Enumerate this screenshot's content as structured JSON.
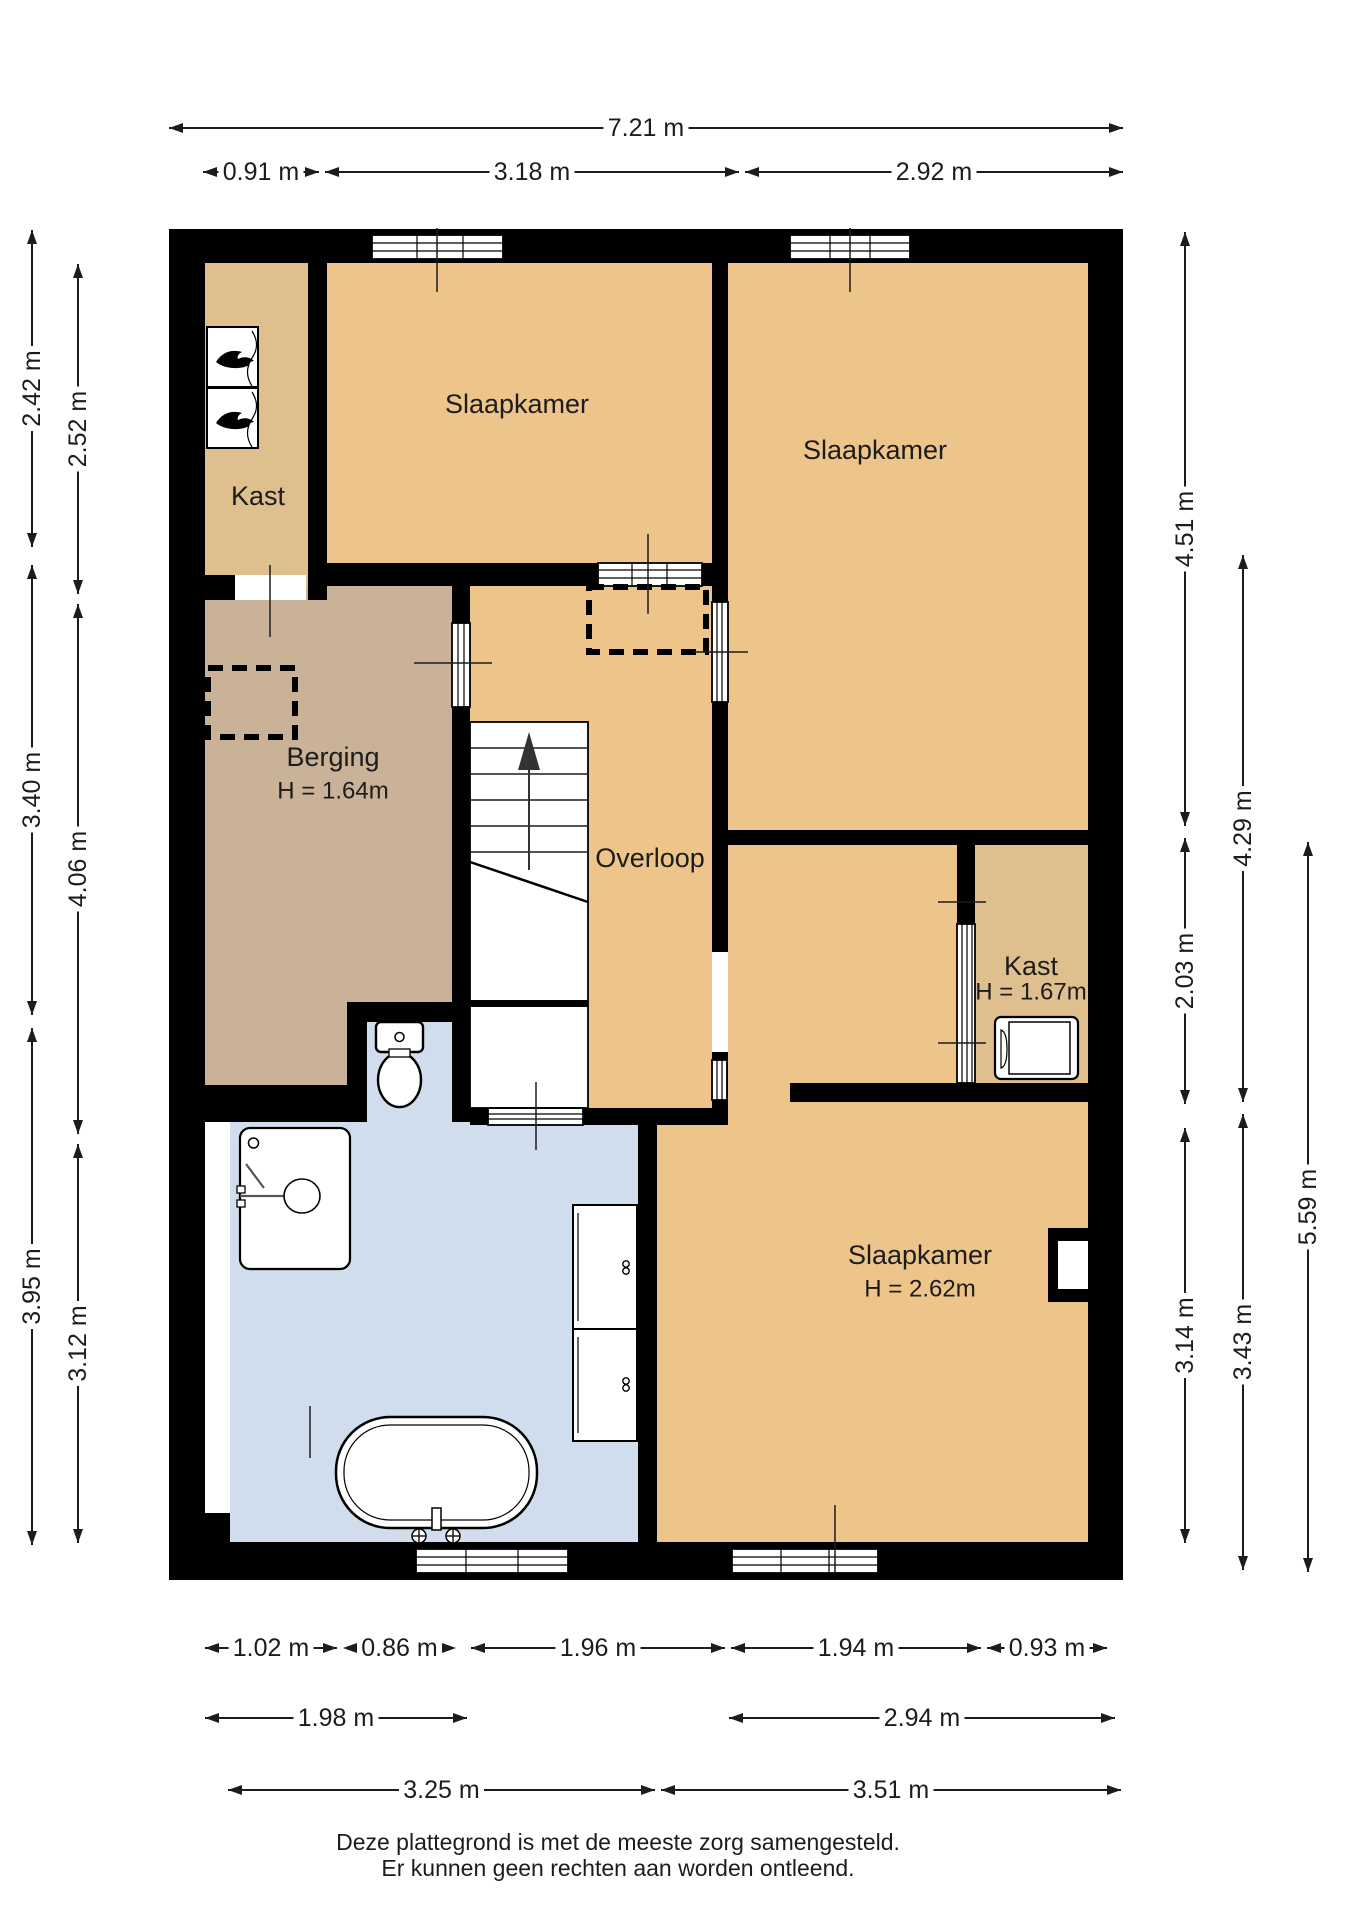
{
  "title": "Plattegrond verdieping",
  "colors": {
    "wall": "#000000",
    "bedroom_floor": "#edc48a",
    "closet_floor": "#debf8d",
    "storage_floor": "#c9b298",
    "bathroom_floor": "#cfdded",
    "fixture": "#ffffff",
    "text": "#1c1c1c"
  },
  "icons": {
    "stairs_arrow": "up-arrow-icon",
    "heater": "flame-icon",
    "washer": "washing-machine-icon",
    "toilet": "toilet-icon",
    "shower": "shower-icon",
    "bathtub": "bathtub-icon",
    "cabinet": "cabinet-icon"
  },
  "rooms": [
    {
      "id": "slaapkamer-1",
      "label": "Slaapkamer",
      "sub": "",
      "x": 517,
      "y": 404,
      "suby": 0
    },
    {
      "id": "slaapkamer-2",
      "label": "Slaapkamer",
      "sub": "",
      "x": 875,
      "y": 450,
      "suby": 0
    },
    {
      "id": "kast-1",
      "label": "Kast",
      "sub": "",
      "x": 258,
      "y": 496,
      "suby": 0
    },
    {
      "id": "berging",
      "label": "Berging",
      "sub": "H = 1.64m",
      "x": 333,
      "y": 757,
      "suby": 791
    },
    {
      "id": "overloop",
      "label": "Overloop",
      "sub": "",
      "x": 650,
      "y": 858,
      "suby": 0
    },
    {
      "id": "kast-2",
      "label": "Kast",
      "sub": "H = 1.67m",
      "x": 1031,
      "y": 966,
      "suby": 992
    },
    {
      "id": "slaapkamer-3",
      "label": "Slaapkamer",
      "sub": "H = 2.62m",
      "x": 920,
      "y": 1255,
      "suby": 1289
    }
  ],
  "dims": [
    {
      "label": "7.21 m",
      "o": "h",
      "x1": 169,
      "x2": 1123,
      "y": 128
    },
    {
      "label": "0.91 m",
      "o": "h",
      "x1": 203,
      "x2": 319,
      "y": 172
    },
    {
      "label": "3.18 m",
      "o": "h",
      "x1": 325,
      "x2": 739,
      "y": 172
    },
    {
      "label": "2.92 m",
      "o": "h",
      "x1": 745,
      "x2": 1123,
      "y": 172
    },
    {
      "label": "2.42 m",
      "o": "v",
      "x": 32,
      "y1": 230,
      "y2": 547
    },
    {
      "label": "3.40 m",
      "o": "v",
      "x": 32,
      "y1": 565,
      "y2": 1015
    },
    {
      "label": "3.95 m",
      "o": "v",
      "x": 32,
      "y1": 1028,
      "y2": 1545
    },
    {
      "label": "2.52 m",
      "o": "v",
      "x": 78,
      "y1": 264,
      "y2": 594
    },
    {
      "label": "4.06 m",
      "o": "v",
      "x": 78,
      "y1": 604,
      "y2": 1134
    },
    {
      "label": "3.12 m",
      "o": "v",
      "x": 78,
      "y1": 1144,
      "y2": 1543
    },
    {
      "label": "4.51 m",
      "o": "v",
      "x": 1185,
      "y1": 232,
      "y2": 826
    },
    {
      "label": "2.03 m",
      "o": "v",
      "x": 1185,
      "y1": 838,
      "y2": 1104
    },
    {
      "label": "3.14 m",
      "o": "v",
      "x": 1185,
      "y1": 1128,
      "y2": 1543
    },
    {
      "label": "4.29 m",
      "o": "v",
      "x": 1243,
      "y1": 555,
      "y2": 1102
    },
    {
      "label": "3.43 m",
      "o": "v",
      "x": 1243,
      "y1": 1114,
      "y2": 1570
    },
    {
      "label": "5.59 m",
      "o": "v",
      "x": 1308,
      "y1": 842,
      "y2": 1572
    },
    {
      "label": "1.02 m",
      "o": "h",
      "x1": 205,
      "x2": 337,
      "y": 1648
    },
    {
      "label": "0.86 m",
      "o": "h",
      "x1": 343,
      "x2": 456,
      "y": 1648
    },
    {
      "label": "1.96 m",
      "o": "h",
      "x1": 471,
      "x2": 725,
      "y": 1648
    },
    {
      "label": "1.94 m",
      "o": "h",
      "x1": 731,
      "x2": 981,
      "y": 1648
    },
    {
      "label": "0.93 m",
      "o": "h",
      "x1": 987,
      "x2": 1107,
      "y": 1648
    },
    {
      "label": "1.98 m",
      "o": "h",
      "x1": 205,
      "x2": 467,
      "y": 1718
    },
    {
      "label": "2.94 m",
      "o": "h",
      "x1": 729,
      "x2": 1115,
      "y": 1718
    },
    {
      "label": "3.25 m",
      "o": "h",
      "x1": 228,
      "x2": 655,
      "y": 1790
    },
    {
      "label": "3.51 m",
      "o": "h",
      "x1": 661,
      "x2": 1121,
      "y": 1790
    }
  ],
  "footer": [
    "Deze plattegrond is met de meeste zorg samengesteld.",
    "Er kunnen geen rechten aan worden ontleend."
  ]
}
